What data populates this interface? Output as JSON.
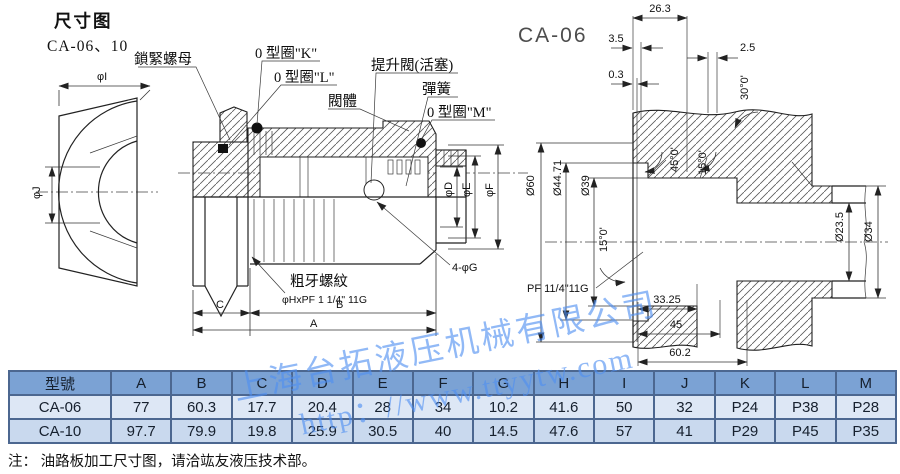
{
  "header": {
    "title": "尺寸图",
    "models": "CA-06、10"
  },
  "front_view": {
    "dim_i": "φI",
    "dim_j": "φJ"
  },
  "section_view": {
    "labels": {
      "lock_nut": "鎖緊螺母",
      "oring_k": "0 型圈\"K\"",
      "oring_l": "0 型圈\"L\"",
      "valve_body": "閥體",
      "poppet": "提升閥(活塞)",
      "spring": "彈簧",
      "oring_m": "0 型圈\"M\"",
      "coarse_thread": "粗牙螺紋",
      "thread_spec": "φHxPF 1 1/4\" 11G",
      "holes": "4-φG"
    },
    "dims": {
      "d": "φD",
      "e": "φE",
      "f": "φF",
      "c": "C",
      "b": "B",
      "a": "A"
    }
  },
  "cavity_view": {
    "title": "CA-06",
    "dims": {
      "d26_3": "26.3",
      "d3_5": "3.5",
      "d0_3": "0.3",
      "d2_5": "2.5",
      "a30": "30°0'",
      "a45": "45°0'",
      "a15": "15°0'",
      "a15b": "15°0'",
      "dia60": "Ø60",
      "dia44_71": "Ø44.71",
      "dia39": "Ø39",
      "dia23_5": "Ø23.5",
      "dia34": "Ø34",
      "thread": "PF 11/4\"11G",
      "d33_25": "33.25",
      "d45": "45",
      "d60_2": "60.2"
    }
  },
  "watermark": {
    "company": "上海台拓液压机械有限公司",
    "url": "http：//www.ttyytw.com",
    "color": "#4f8ff2"
  },
  "table": {
    "headers": [
      "型號",
      "A",
      "B",
      "C",
      "D",
      "E",
      "F",
      "G",
      "H",
      "I",
      "J",
      "K",
      "L",
      "M"
    ],
    "rows": [
      {
        "model": "CA-06",
        "values": [
          "77",
          "60.3",
          "17.7",
          "20.4",
          "28",
          "34",
          "10.2",
          "41.6",
          "50",
          "32",
          "P24",
          "P38",
          "P28"
        ]
      },
      {
        "model": "CA-10",
        "values": [
          "97.7",
          "79.9",
          "19.8",
          "25.9",
          "30.5",
          "40",
          "14.5",
          "47.6",
          "57",
          "41",
          "P29",
          "P45",
          "P35"
        ]
      }
    ],
    "colors": {
      "header_bg": "#7ba2d4",
      "row1_bg": "#dde7f5",
      "row2_bg": "#c9d9ee",
      "border": "#4c6790"
    }
  },
  "note": "注： 油路板加工尺寸图，请洽竑友液压技术部。"
}
